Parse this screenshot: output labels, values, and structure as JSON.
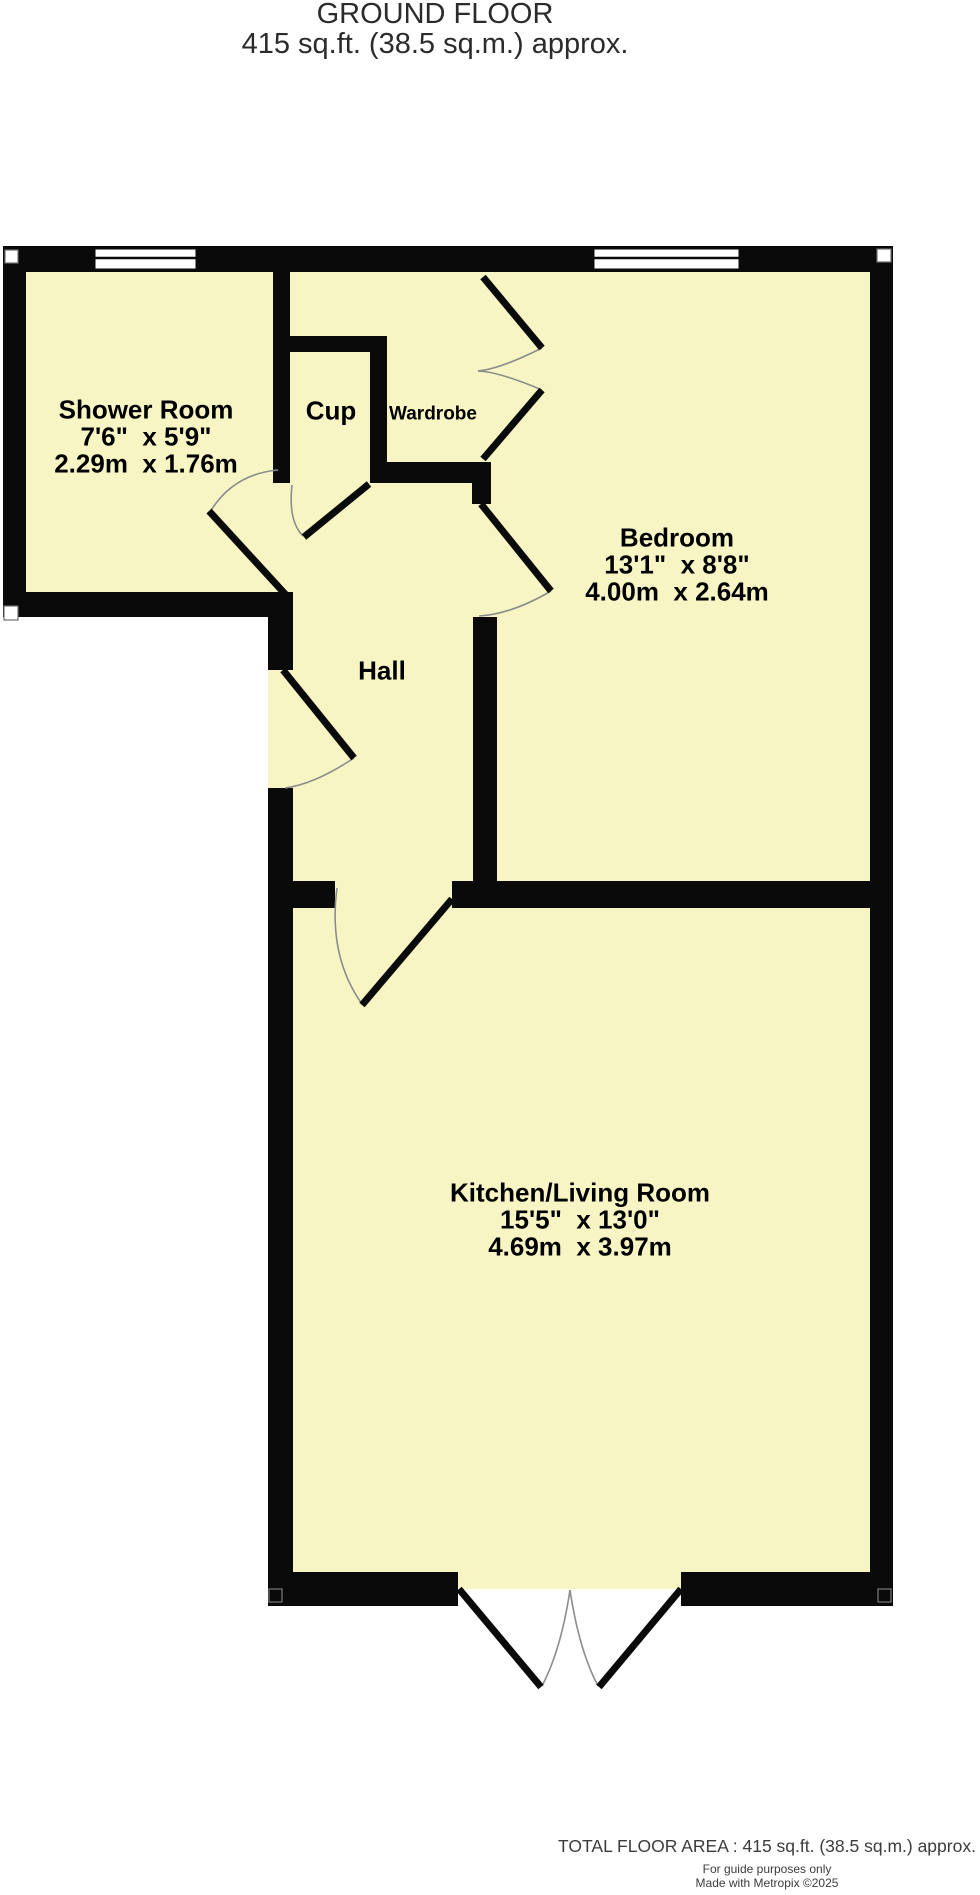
{
  "title": {
    "floor_name": "GROUND FLOOR",
    "area": "415 sq.ft. (38.5 sq.m.) approx."
  },
  "rooms": {
    "shower": {
      "name": "Shower Room",
      "imperial": "7'6\"  x 5'9\"",
      "metric": "2.29m  x 1.76m"
    },
    "cup": {
      "name": "Cup"
    },
    "wardrobe": {
      "name": "Wardrobe"
    },
    "bedroom": {
      "name": "Bedroom",
      "imperial": "13'1\"  x 8'8\"",
      "metric": "4.00m  x 2.64m"
    },
    "hall": {
      "name": "Hall"
    },
    "kitchen": {
      "name": "Kitchen/Living Room",
      "imperial": "15'5\"  x 13'0\"",
      "metric": "4.69m  x 3.97m"
    }
  },
  "footer": {
    "total_area": "TOTAL FLOOR AREA : 415 sq.ft. (38.5 sq.m.) approx.",
    "disclaimer": "For guide purposes only",
    "credit": "Made with Metropix ©2025"
  },
  "colors": {
    "floor": "#F8F5C4",
    "wall": "#0A0A0A",
    "arc": "#8C8C8C",
    "label": "#000000",
    "meta_text": "#3C3C3C"
  }
}
